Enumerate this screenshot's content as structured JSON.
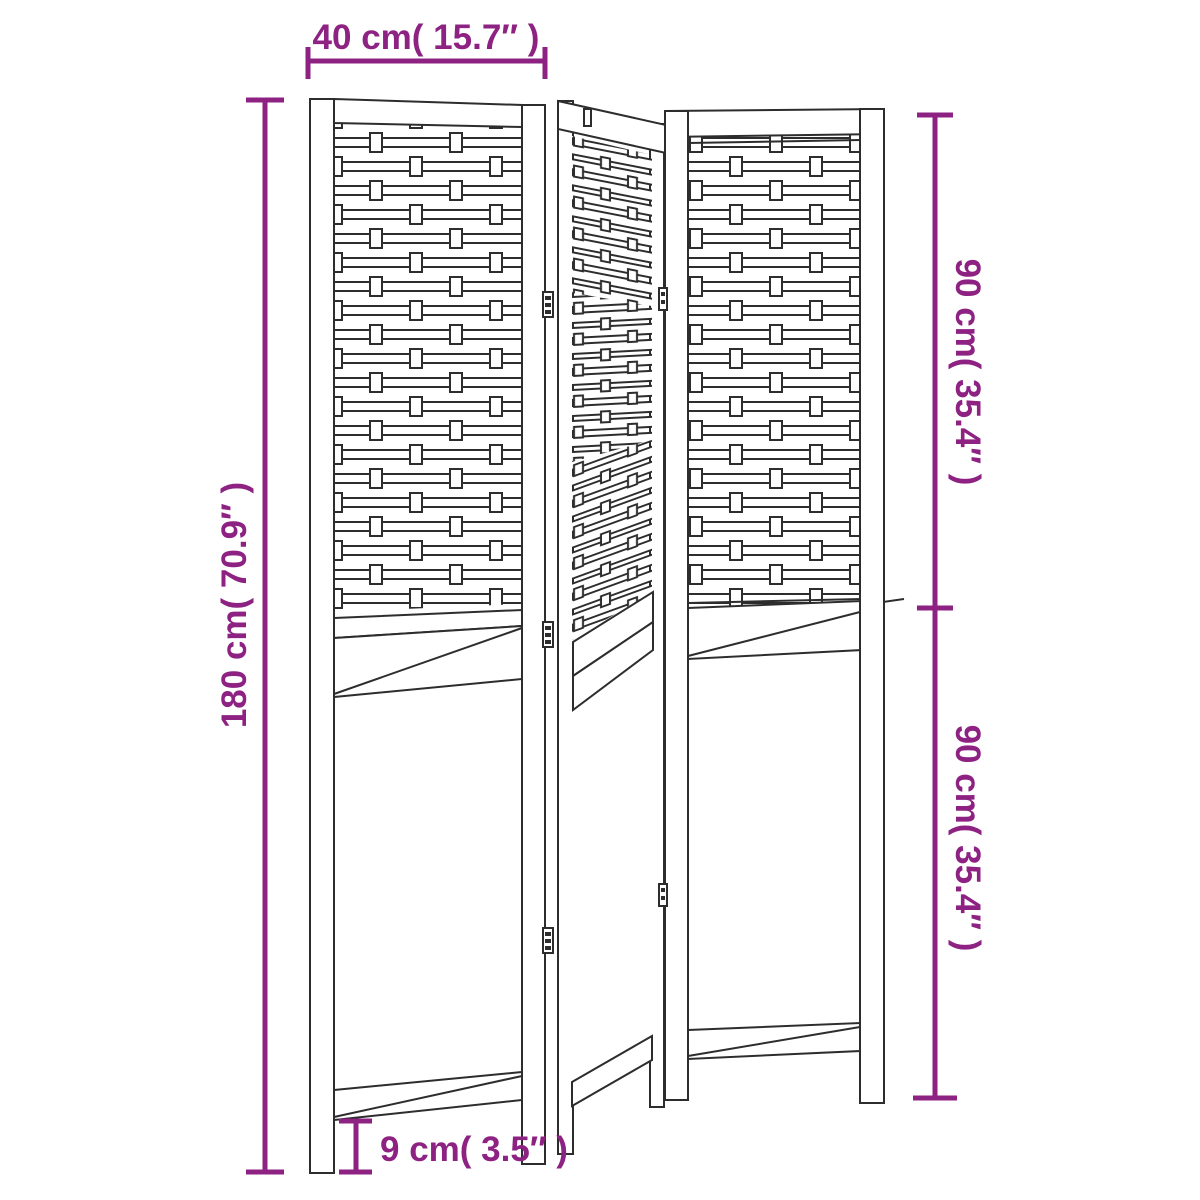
{
  "figure": {
    "drawing": "room-divider-3-panel-line-drawing"
  },
  "dimensions": {
    "width_top": "40 cm( 15.7″ )",
    "height_left": "180 cm( 70.9″ )",
    "height_right_upper": "90 cm( 35.4″ )",
    "height_right_lower": "90 cm( 35.4″ )",
    "leg_height": "9 cm( 3.5″ )"
  },
  "colors": {
    "dimension_accent": "#8d2283",
    "drawing_line": "#2d2d2d",
    "background": "#ffffff"
  }
}
